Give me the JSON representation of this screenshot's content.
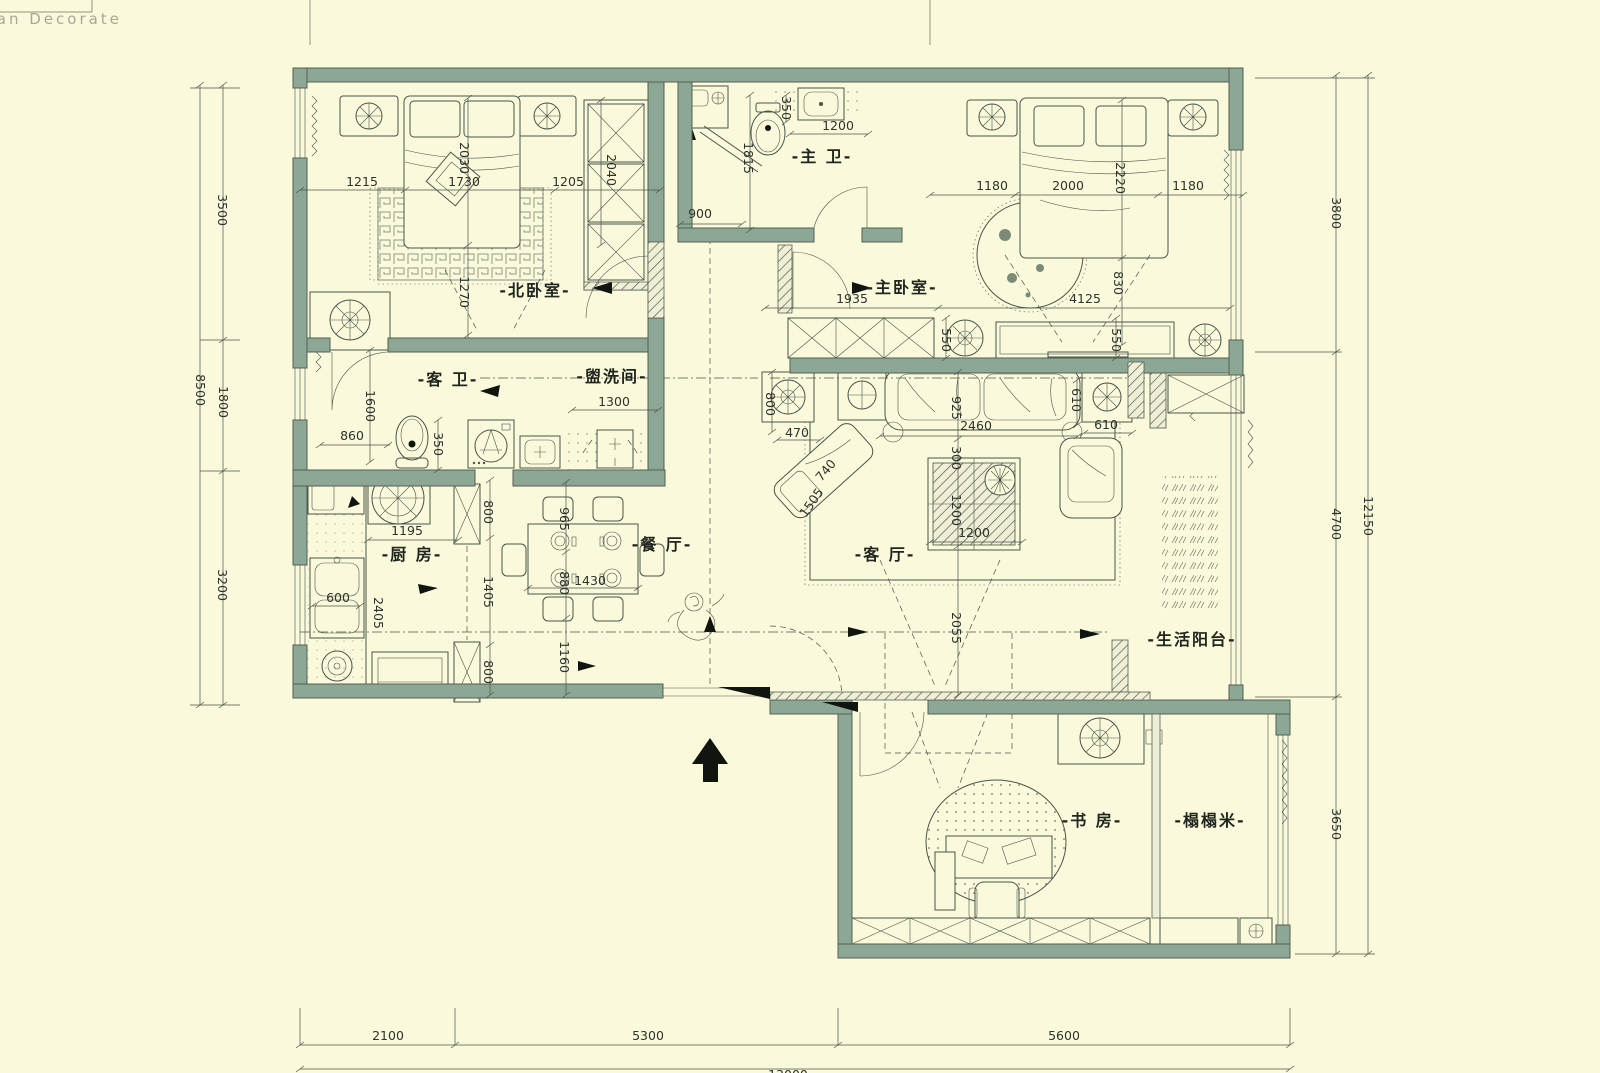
{
  "logo": "anan Decorate",
  "colors": {
    "background": "#FAF9DC",
    "wall": "#8CA795",
    "wall_edge": "#55604F",
    "line": "#4A5548",
    "dim_text": "#2E332B"
  },
  "rooms": {
    "north_bedroom": "-北卧室-",
    "master_bedroom": "-主卧室-",
    "master_bath": "-主 卫-",
    "guest_bath": "-客 卫-",
    "washroom": "-盥洗间-",
    "kitchen": "-厨 房-",
    "dining": "-餐 厅-",
    "living": "-客 厅-",
    "balcony": "-生活阳台-",
    "study": "-书 房-",
    "tatami": "-榻榻米-"
  },
  "dim_labels": {
    "nb_1215": "1215",
    "nb_1730": "1730",
    "nb_1205": "1205",
    "nb_2030": "2030",
    "nb_2040": "2040",
    "nb_1270": "1270",
    "mb_900": "900",
    "mb_1815": "1815",
    "mb_350": "350",
    "mb_1200": "1200",
    "mbr_1180L": "1180",
    "mbr_2000": "2000",
    "mbr_1180R": "1180",
    "mbr_2220": "2220",
    "mbr_830": "830",
    "mbr_1935": "1935",
    "mbr_4125": "4125",
    "mbr_550a": "550",
    "mbr_550b": "550",
    "gb_1600": "1600",
    "gb_860": "860",
    "gb_350": "350",
    "wr_1300": "1300",
    "lv_800": "800",
    "lv_470": "470",
    "lv_925": "925",
    "lv_2460": "2460",
    "lv_610a": "610",
    "lv_610b": "610",
    "lv_300": "300",
    "lv_740": "740",
    "lv_1505": "1505",
    "lv_1200a": "1200",
    "lv_1200b": "1200",
    "lv_2055": "2055",
    "kt_1195": "1195",
    "kt_600": "600",
    "kt_2405": "2405",
    "kt_800a": "800",
    "kt_1405": "1405",
    "kt_800b": "800",
    "dn_965": "965",
    "dn_880": "880",
    "dn_1430": "1430",
    "dn_1160": "1160",
    "out_3500": "3500",
    "out_1800": "1800",
    "out_3200": "3200",
    "out_8500": "8500",
    "out_3800": "3800",
    "out_4700": "4700",
    "out_3650": "3650",
    "out_12150": "12150",
    "out_2100": "2100",
    "out_5300": "5300",
    "out_5600": "5600",
    "out_total": "13000"
  }
}
